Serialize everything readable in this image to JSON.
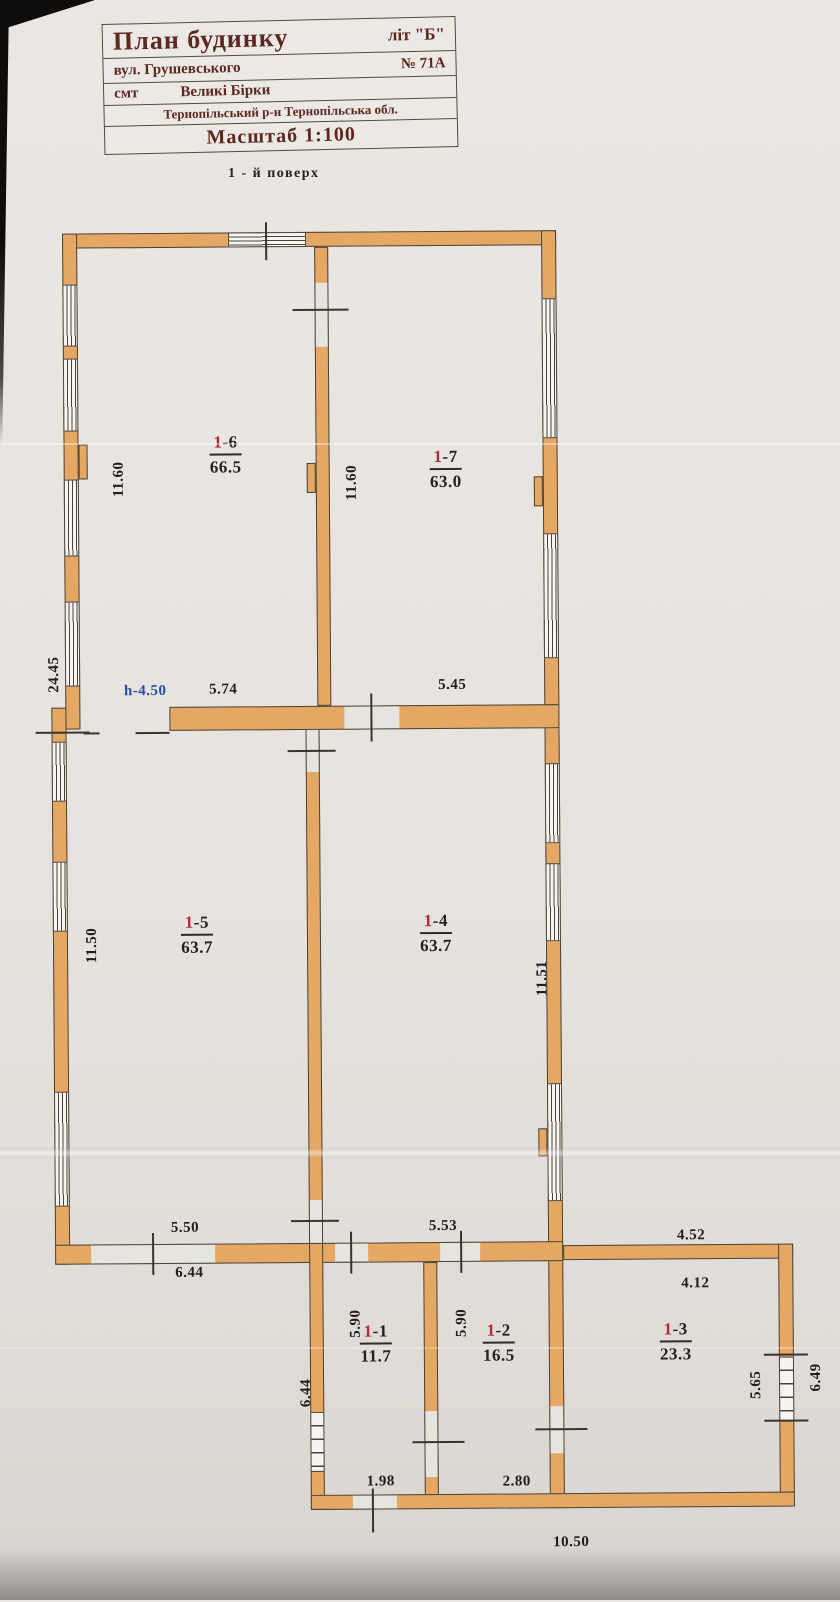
{
  "title_block": {
    "row1_left": "План будинку",
    "row1_right": "літ \"Б\"",
    "row2_left": "вул. Грушевського",
    "row2_right": "№ 71А",
    "row3_left": "смт",
    "row3_right": "Великі Бірки",
    "row4": "Тернопільський р-н  Тернопільська обл.",
    "row5": "Масштаб 1:100"
  },
  "floor_label": "1 - й  поверх",
  "rooms": [
    {
      "name": "1-1",
      "num_red": "1",
      "num_black": "-1",
      "area": "11.7"
    },
    {
      "name": "1-2",
      "num_red": "1",
      "num_black": "-2",
      "area": "16.5"
    },
    {
      "name": "1-3",
      "num_red": "1",
      "num_black": "-3",
      "area": "23.3"
    },
    {
      "name": "1-4",
      "num_red": "1",
      "num_black": "-4",
      "area": "63.7"
    },
    {
      "name": "1-5",
      "num_red": "1",
      "num_black": "-5",
      "area": "63.7"
    },
    {
      "name": "1-6",
      "num_red": "1",
      "num_black": "-6",
      "area": "66.5"
    },
    {
      "name": "1-7",
      "num_red": "1",
      "num_black": "-7",
      "area": "63.0"
    }
  ],
  "dims": [
    {
      "text": "11.60"
    },
    {
      "text": "11.60"
    },
    {
      "text": "24.45"
    },
    {
      "text": "h-4.50"
    },
    {
      "text": "5.74"
    },
    {
      "text": "5.45"
    },
    {
      "text": "11.50"
    },
    {
      "text": "11.51"
    },
    {
      "text": "5.50"
    },
    {
      "text": "6.44"
    },
    {
      "text": "5.53"
    },
    {
      "text": "4.52"
    },
    {
      "text": "4.12"
    },
    {
      "text": "6.44"
    },
    {
      "text": "5.90"
    },
    {
      "text": "5.90"
    },
    {
      "text": "5.65"
    },
    {
      "text": "6.49"
    },
    {
      "text": "1.98"
    },
    {
      "text": "2.80"
    },
    {
      "text": "10.50"
    }
  ],
  "colors": {
    "wall_fill": "#e5a764",
    "wall_line": "#4a4338",
    "title_text": "#5e2722",
    "room_number_red": "#b02c3e",
    "dim_blue": "#27509e",
    "dim_text": "#211f1b",
    "paper": "#e6e3de"
  }
}
